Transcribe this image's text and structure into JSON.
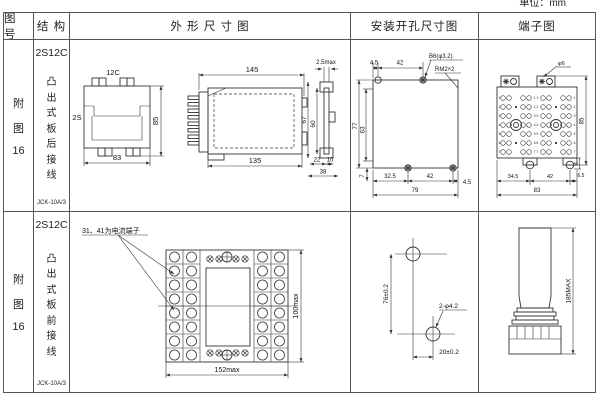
{
  "page": {
    "unit_label": "单位：mm"
  },
  "table": {
    "headers": {
      "figure_no": "图 号",
      "structure": "结 构",
      "outline": "外 形 尺 寸 图",
      "mounting": "安装开孔尺寸图",
      "terminal": "端子图"
    }
  },
  "rows": [
    {
      "figure_no_lines": [
        "附",
        "图",
        "16"
      ],
      "structure": {
        "model": "2S12C",
        "type": "凸出式板后接线",
        "code": "JCK-10A/3"
      },
      "outline": {
        "front": {
          "top": "12C",
          "left": "2S",
          "height": "85",
          "width": "83"
        },
        "side": {
          "top": "145",
          "bottom": "135"
        },
        "edge": {
          "top": "2.5max",
          "d67": "67",
          "d60": "60",
          "d22": "22",
          "d10": "10",
          "d38": "38"
        }
      },
      "mounting": {
        "d45": "4.5",
        "d42": "42",
        "hole": "B6(φ3.2)",
        "thread": "RM2×2",
        "d77": "77",
        "d63": "63",
        "d7": "7",
        "d325": "32.5",
        "d42b": "42",
        "d45b": "4.5",
        "d79": "79"
      },
      "terminal": {
        "screw": "φ6",
        "height": "85",
        "d4": "4",
        "d345": "34.5",
        "d42": "42",
        "d65": "6.5",
        "d83": "83",
        "rowNums": [
          "1",
          "2",
          "3",
          "4",
          "5",
          "6",
          "7"
        ],
        "centerRows": [
          "1 1",
          "2 2",
          "3 3",
          "4 4",
          "5 5",
          "6 6",
          "7 7"
        ]
      }
    },
    {
      "figure_no_lines": [
        "附",
        "图",
        "16"
      ],
      "structure": {
        "model": "2S12C",
        "type": "凸出式板前接线",
        "code": "JCK-10A/3"
      },
      "outline": {
        "note": "31、41为电流端子",
        "width": "152max",
        "height": "100max"
      },
      "mounting": {
        "v": "76±0.2",
        "hole": "2-φ4.2",
        "h": "20±0.2"
      },
      "terminal": {
        "height": "185MAX"
      }
    }
  ]
}
